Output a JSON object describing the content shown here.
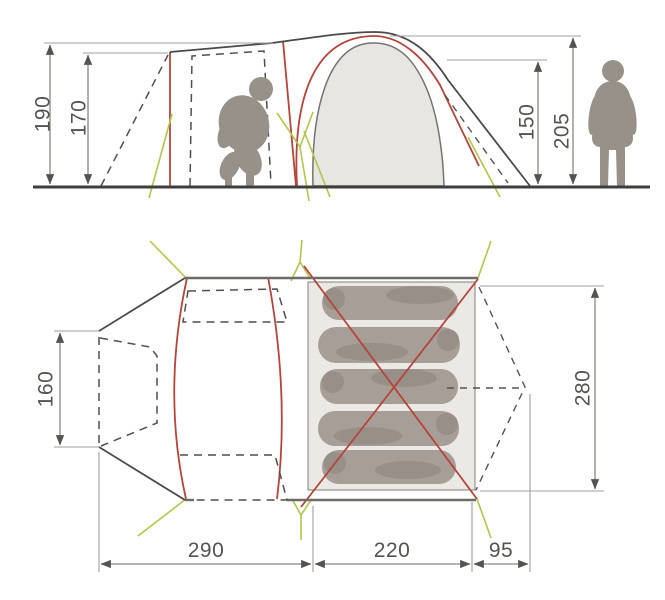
{
  "diagram": {
    "side_view": {
      "dimensions": {
        "canopy_height": "190",
        "door_height": "170",
        "inner_cabin_height": "150",
        "dome_peak_height": "205"
      }
    },
    "floor_plan": {
      "dimensions": {
        "front_width": "160",
        "sleeping_width": "280",
        "living_area_length": "290",
        "sleeping_cabin_length": "220",
        "rear_beak_length": "95"
      },
      "sleeper_count": 5
    },
    "colors": {
      "pole_red": "#b5443a",
      "guy_line_green": "#b5c44c",
      "silhouette_gray": "#97918a",
      "sleeper_gray": "#a39b93",
      "fabric_fill": "#e8e6e3",
      "cabin_fill": "#ebe9e6"
    }
  }
}
